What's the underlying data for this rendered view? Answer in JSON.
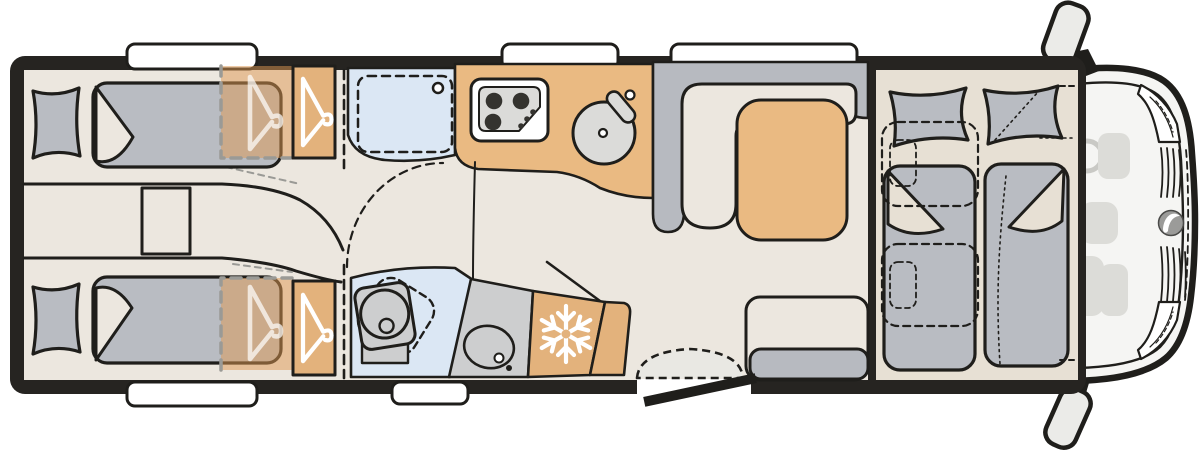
{
  "document": {
    "kind": "motorhome-floor-plan",
    "view": "top-down",
    "cab_position": "right",
    "visible_text": ""
  },
  "colors": {
    "ink": "#1f1e1b",
    "wall": "#262421",
    "floor": "#ece7df",
    "platform": "#e7e0d4",
    "tan": "#eaba82",
    "tan-deep": "#e3b27c",
    "tan-glass": "rgba(222,152,82,0.5)",
    "blue": "#dbe7f4",
    "soft-gray": "#b9bcc2",
    "bench-gray": "#b7bac0",
    "hard-gray": "#cdcecf",
    "panel-gray": "#dbdbd9",
    "burner": "#34332f",
    "ghost": "#dcdcd8",
    "ghost-line": "#c9c9c5",
    "body": "#f5f5f3",
    "mirror": "#ebebe8",
    "step": "#e9e8e3",
    "white": "#ffffff",
    "logo-gray": "#9b9b99",
    "dash-gray": "#9a9a96"
  },
  "icons": [
    {
      "name": "hanger-icon",
      "meaning": "wardrobe",
      "count": 4
    },
    {
      "name": "snowflake-icon",
      "meaning": "refrigerator",
      "count": 1
    },
    {
      "name": "brand-logo-icon",
      "meaning": "manufacturer emblem",
      "count": 1
    }
  ],
  "areas": [
    {
      "name": "rear-bedroom",
      "furniture": [
        "single-bed",
        "single-bed",
        "bedside-cabinet",
        "wardrobe",
        "wardrobe"
      ]
    },
    {
      "name": "washroom",
      "furniture": [
        "shower-tray",
        "swivel-toilet",
        "washbasin-counter"
      ]
    },
    {
      "name": "kitchen",
      "furniture": [
        "three-burner-hob",
        "round-sink",
        "refrigerator",
        "counter"
      ]
    },
    {
      "name": "lounge",
      "furniture": [
        "l-shaped-dinette",
        "table",
        "side-bench",
        "entry-door",
        "entry-step"
      ]
    },
    {
      "name": "cab",
      "furniture": [
        "drop-down-bed",
        "driver-seat-outline",
        "passenger-seat-outline",
        "steering-wheel",
        "side-mirror",
        "side-mirror"
      ]
    }
  ],
  "windows": {
    "top_wall": 3,
    "bottom_wall": 2
  }
}
